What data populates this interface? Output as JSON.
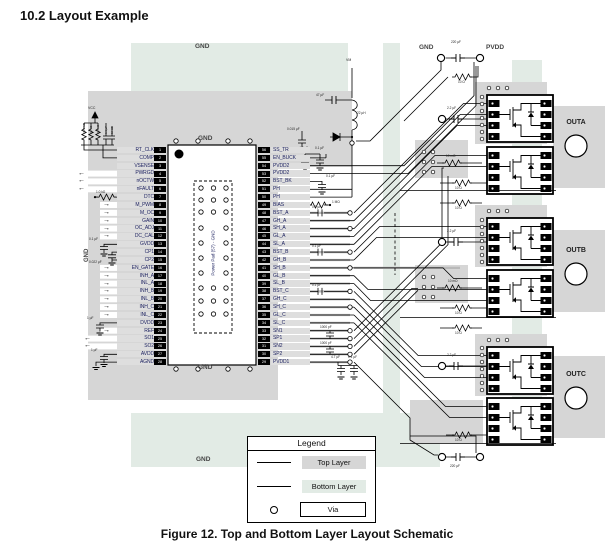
{
  "title": "10.2   Layout Example",
  "caption": "Figure 12.  Top and Bottom Layer Layout Schematic",
  "legend": {
    "title": "Legend",
    "top_layer": "Top Layer",
    "bottom_layer": "Bottom Layer",
    "via": "Via"
  },
  "labels": {
    "gnd_plane_top": "GND",
    "gnd_plane_bottom": "GND",
    "gnd_chip_top": "GND",
    "gnd_chip_bottom": "GND",
    "gnd_left_rotated": "GND",
    "gnd_supply": "GND",
    "pvdd": "PVDD",
    "vm": "VM",
    "vcc": "VCC"
  },
  "outputs": {
    "a": "OUTA",
    "b": "OUTB",
    "c": "OUTC"
  },
  "ic": {
    "power_pad_label": "Power Pad (57) - GND",
    "left_pins": [
      {
        "num": "1",
        "name": "RT_CLK"
      },
      {
        "num": "2",
        "name": "COMP"
      },
      {
        "num": "3",
        "name": "VSENSE"
      },
      {
        "num": "4",
        "name": "PWRGD"
      },
      {
        "num": "5",
        "name": "nOCTW"
      },
      {
        "num": "6",
        "name": "nFAULT"
      },
      {
        "num": "7",
        "name": "DTC"
      },
      {
        "num": "8",
        "name": "M_PWM"
      },
      {
        "num": "9",
        "name": "M_OC"
      },
      {
        "num": "10",
        "name": "GAIN"
      },
      {
        "num": "11",
        "name": "OC_ADJ"
      },
      {
        "num": "12",
        "name": "DC_CAL"
      },
      {
        "num": "13",
        "name": "GVDD"
      },
      {
        "num": "14",
        "name": "CP1"
      },
      {
        "num": "15",
        "name": "CP2"
      },
      {
        "num": "16",
        "name": "EN_GATE"
      },
      {
        "num": "17",
        "name": "INH_A"
      },
      {
        "num": "18",
        "name": "INL_A"
      },
      {
        "num": "19",
        "name": "INH_B"
      },
      {
        "num": "20",
        "name": "INL_B"
      },
      {
        "num": "21",
        "name": "INH_C"
      },
      {
        "num": "22",
        "name": "INL_C"
      },
      {
        "num": "23",
        "name": "DVDD"
      },
      {
        "num": "24",
        "name": "REF"
      },
      {
        "num": "25",
        "name": "SO1"
      },
      {
        "num": "26",
        "name": "SO2"
      },
      {
        "num": "27",
        "name": "AVDD"
      },
      {
        "num": "28",
        "name": "AGND"
      }
    ],
    "right_pins": [
      {
        "num": "56",
        "name": "SS_TR"
      },
      {
        "num": "55",
        "name": "EN_BUCK"
      },
      {
        "num": "54",
        "name": "PVDD2"
      },
      {
        "num": "53",
        "name": "PVDD2"
      },
      {
        "num": "52",
        "name": "BST_BK"
      },
      {
        "num": "51",
        "name": "PH"
      },
      {
        "num": "50",
        "name": "PH"
      },
      {
        "num": "49",
        "name": "BIAS"
      },
      {
        "num": "48",
        "name": "BST_A"
      },
      {
        "num": "47",
        "name": "GH_A"
      },
      {
        "num": "46",
        "name": "SH_A"
      },
      {
        "num": "45",
        "name": "GL_A"
      },
      {
        "num": "44",
        "name": "SL_A"
      },
      {
        "num": "43",
        "name": "BST_B"
      },
      {
        "num": "42",
        "name": "GH_B"
      },
      {
        "num": "41",
        "name": "SH_B"
      },
      {
        "num": "40",
        "name": "GL_B"
      },
      {
        "num": "39",
        "name": "SL_B"
      },
      {
        "num": "38",
        "name": "BST_C"
      },
      {
        "num": "37",
        "name": "GH_C"
      },
      {
        "num": "36",
        "name": "SH_C"
      },
      {
        "num": "35",
        "name": "GL_C"
      },
      {
        "num": "34",
        "name": "SL_C"
      },
      {
        "num": "33",
        "name": "SN1"
      },
      {
        "num": "32",
        "name": "SP1"
      },
      {
        "num": "31",
        "name": "SN2"
      },
      {
        "num": "30",
        "name": "SP2"
      },
      {
        "num": "29",
        "name": "PVDD1"
      }
    ]
  },
  "comps": {
    "c220_top": "220 µF",
    "c220_bot": "220 µF",
    "r10": "10 Ω",
    "c2u2": "2.2 µF",
    "r10m": "10 mΩ",
    "c015": "0.015 µF",
    "c4u7_top": "4.7 µF",
    "c01_top": "0.1 µF",
    "c01_bstbk": "0.1 µF",
    "r1m": "1 MΩ",
    "c01_bsta": "0.1 µF",
    "c01_bstb": "0.1 µF",
    "c01_bstc": "0.1 µF",
    "c1000a": "1000 pF",
    "c1000b": "1000 pF",
    "c4u7_pvdd1": "4.7 µF",
    "c01_pvdd1": "0.1 µF",
    "c47": "47 µF",
    "l22": "22 µH",
    "c01_gvdd": "0.1 µF",
    "c022_cp": "0.022 µF",
    "c1_dvdd": "1 µF",
    "c1_avdd": "1 µF",
    "r_dtc": "1.0 kΩ",
    "rclu": [
      "39.2 kΩ",
      "10 kΩ",
      "1.0 kΩ",
      "0.1 µF",
      "10 kΩ"
    ]
  },
  "icons": {
    "arrow_right": "→",
    "arrow_left": "←"
  },
  "colors": {
    "top_layer": "#d6d6d6",
    "bottom_layer": "#e2ebe5",
    "accent": "#000000"
  }
}
